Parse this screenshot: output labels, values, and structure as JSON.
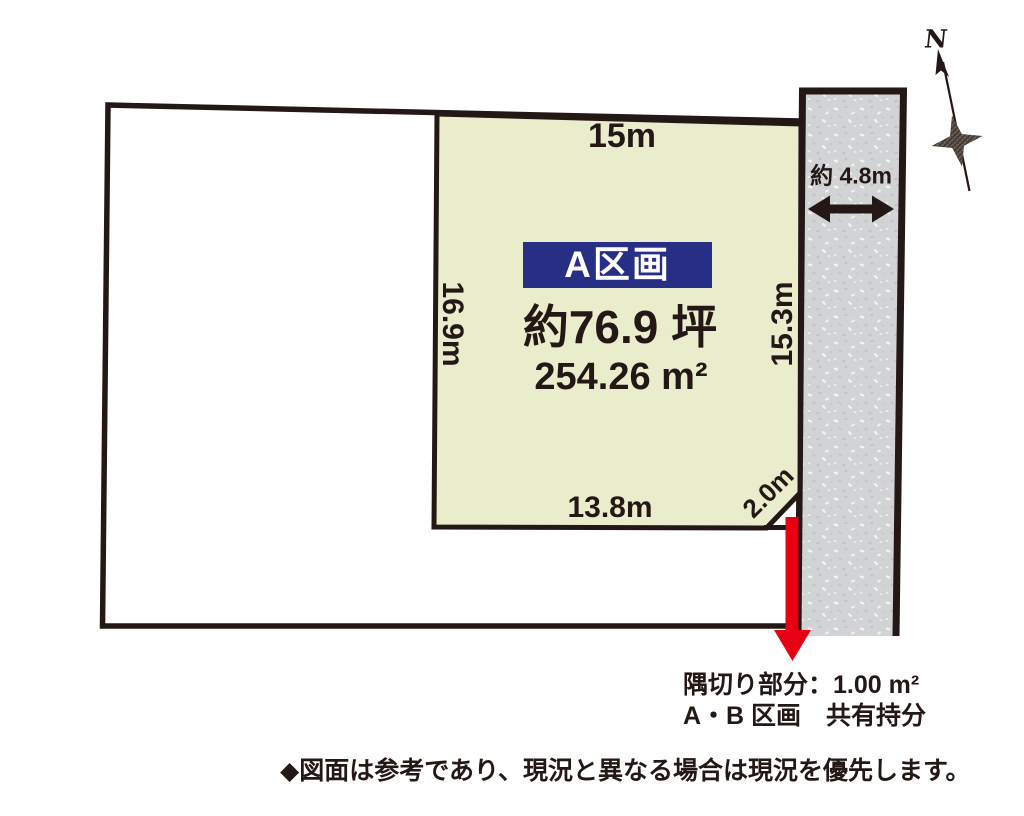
{
  "plot": {
    "label": "A区画",
    "area_tsubo": "約76.9 坪",
    "area_sqm": "254.26 m²"
  },
  "dimensions": {
    "top": "15m",
    "left": "16.9m",
    "right": "15.3m",
    "bottom": "13.8m",
    "corner_cut": "2.0m"
  },
  "road": {
    "width_label": "約 4.8m"
  },
  "compass": {
    "north_label": "N"
  },
  "corner_note": {
    "line1": "隅切り部分：1.00 m²",
    "line2": "A・B 区画　共有持分"
  },
  "footnote": "◆図面は参考であり、現況と異なる場合は現況を優先します。",
  "colors": {
    "outline": "#231815",
    "plot_fill": "#e9edcb",
    "road_fill": "#d2d3d5",
    "label_bg": "#272e85",
    "arrow_red": "#e60012"
  }
}
